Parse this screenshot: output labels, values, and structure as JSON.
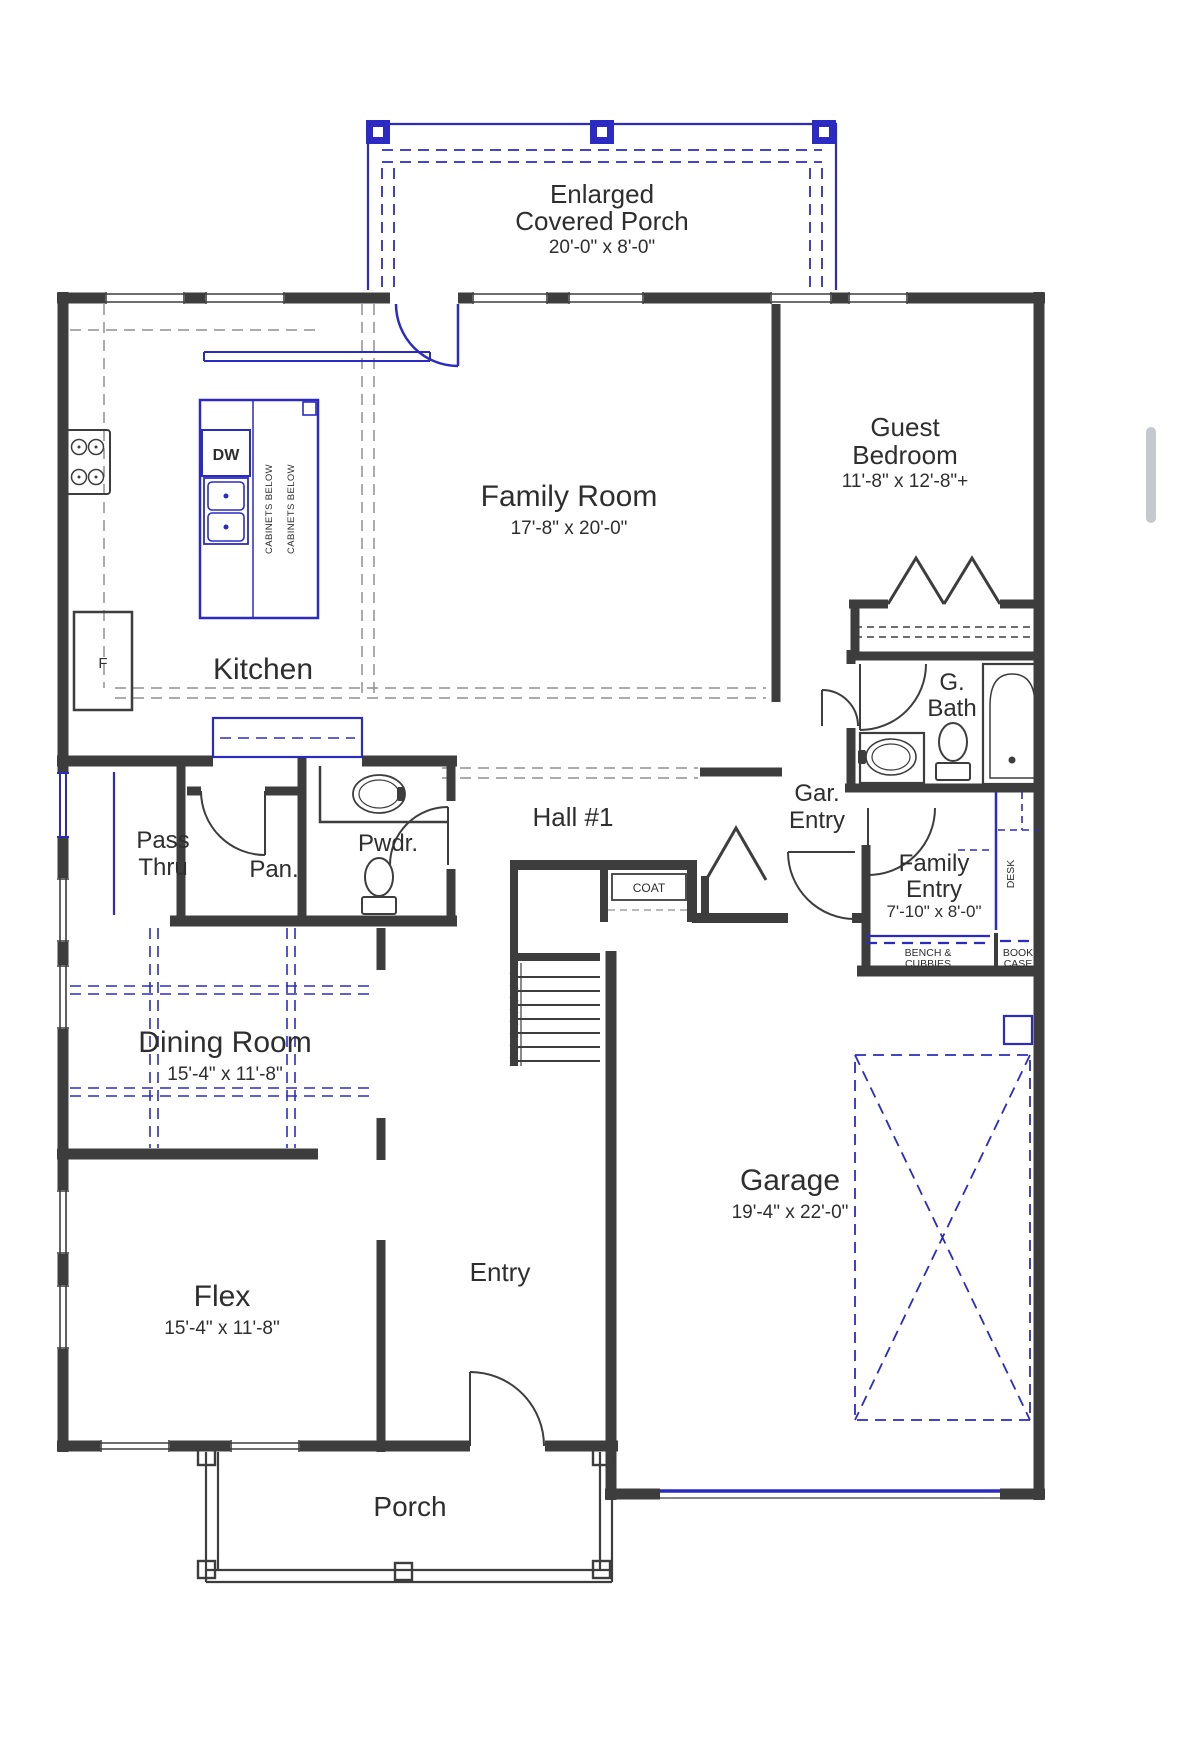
{
  "colors": {
    "wall": "#3d3d3d",
    "accent_blue": "#2b2bc4",
    "dash_gray": "#8f8f8f",
    "text": "#2e2e2e",
    "background": "#ffffff",
    "scrollbar": "#c5c8cd"
  },
  "rooms": {
    "covered_porch": {
      "line1": "Enlarged",
      "line2": "Covered Porch",
      "dims": "20'-0\" x 8'-0\""
    },
    "family_room": {
      "name": "Family Room",
      "dims": "17'-8\" x 20'-0\""
    },
    "guest_bedroom": {
      "line1": "Guest",
      "line2": "Bedroom",
      "dims": "11'-8\" x 12'-8\"+"
    },
    "kitchen": {
      "name": "Kitchen"
    },
    "guest_bath": {
      "line1": "G.",
      "line2": "Bath"
    },
    "pass_thru": {
      "line1": "Pass",
      "line2": "Thru"
    },
    "pantry": {
      "name": "Pan."
    },
    "powder": {
      "name": "Pwdr."
    },
    "hall_1": {
      "name": "Hall #1"
    },
    "garage_entry": {
      "line1": "Gar.",
      "line2": "Entry"
    },
    "family_entry": {
      "line1": "Family",
      "line2": "Entry",
      "dims": "7'-10\" x 8'-0\""
    },
    "dining_room": {
      "name": "Dining Room",
      "dims": "15'-4\" x 11'-8\""
    },
    "garage": {
      "name": "Garage",
      "dims": "19'-4\" x 22'-0\""
    },
    "flex": {
      "name": "Flex",
      "dims": "15'-4\" x 11'-8\""
    },
    "entry": {
      "name": "Entry"
    },
    "porch": {
      "name": "Porch"
    }
  },
  "fixtures": {
    "dishwasher": "DW",
    "fridge": "F",
    "coat_closet": "COAT",
    "desk": "DESK",
    "bench": {
      "line1": "BENCH &",
      "line2": "CUBBIES"
    },
    "bookcase": {
      "line1": "BOOK",
      "line2": "CASE"
    },
    "island_note_1": "CABINETS BELOW",
    "island_note_2": "CABINETS BELOW"
  }
}
